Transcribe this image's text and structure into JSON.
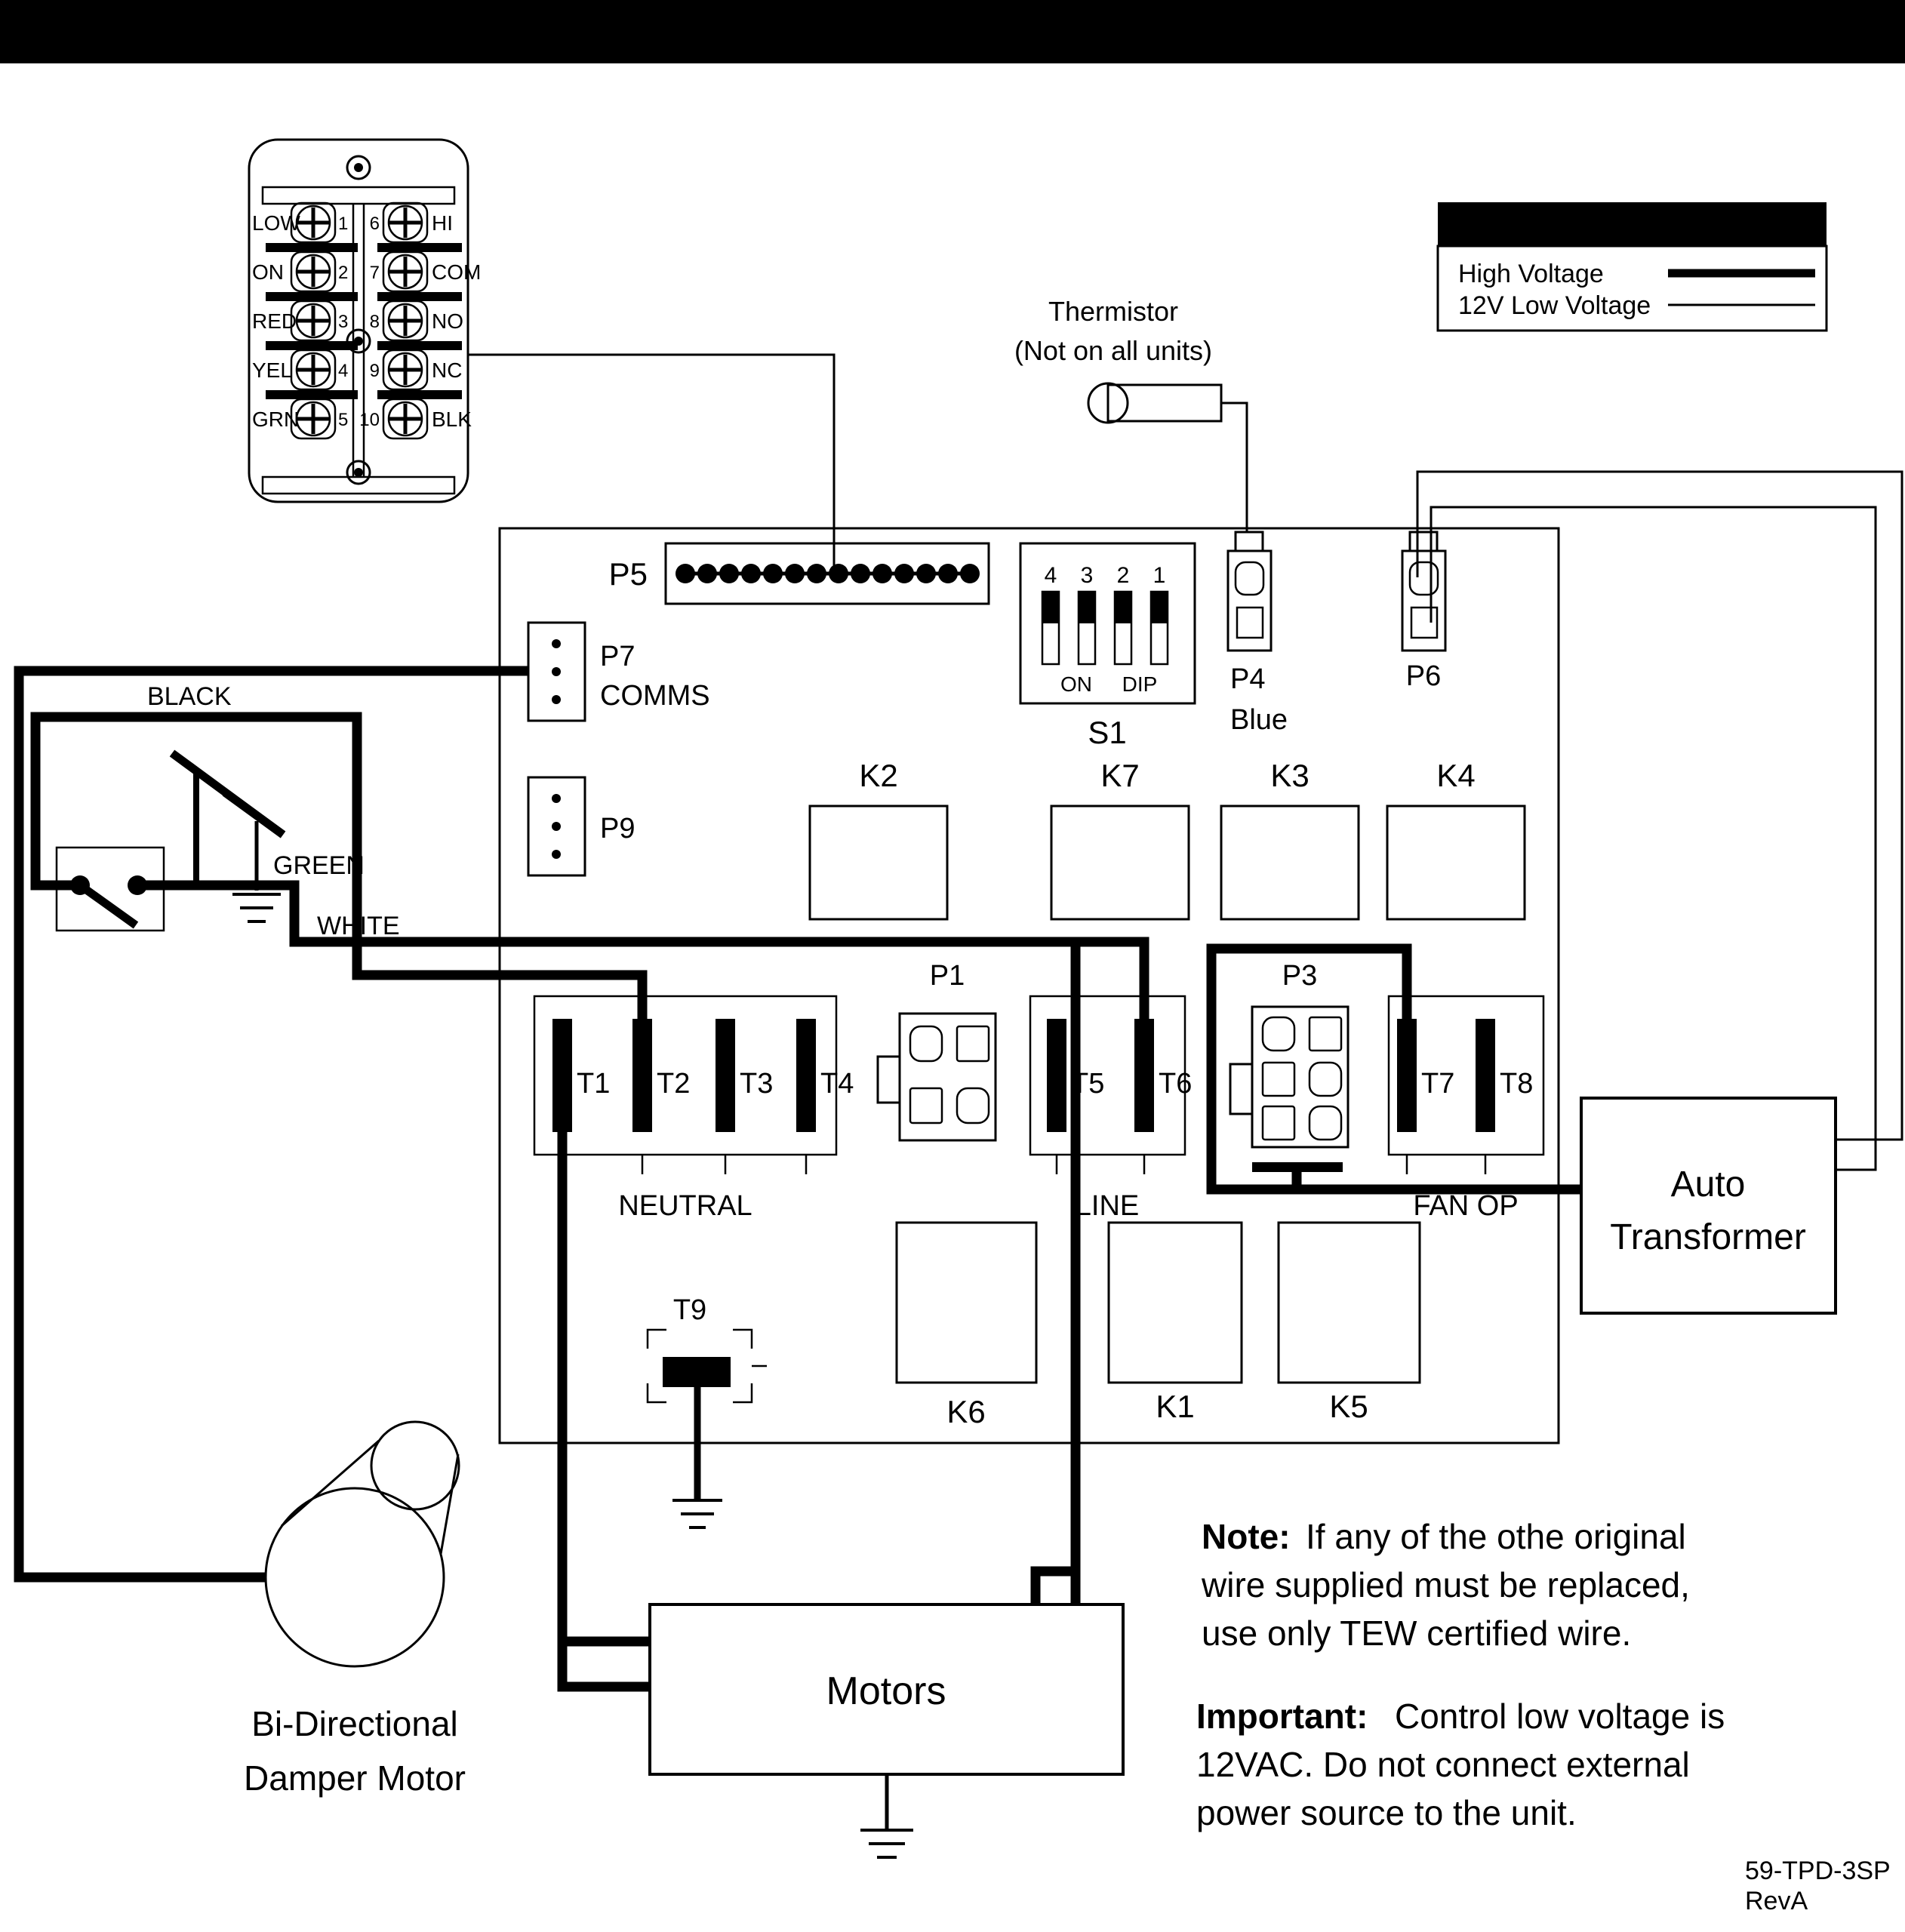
{
  "banner": {
    "bold": "CAUTION:",
    "rest": "ELECTRICAL CONTROL PANEL, SERVICE  BY ELECTRICIAN ONLY"
  },
  "terminal_rows": [
    {
      "left": "LOW",
      "lnum": "1",
      "rnum": "6",
      "right": "HI"
    },
    {
      "left": "ON",
      "lnum": "2",
      "rnum": "7",
      "right": "COM"
    },
    {
      "left": "RED",
      "lnum": "3",
      "rnum": "8",
      "right": "NO"
    },
    {
      "left": "YEL",
      "lnum": "4",
      "rnum": "9",
      "right": "NC"
    },
    {
      "left": "GRN",
      "lnum": "5",
      "rnum": "10",
      "right": "BLK"
    }
  ],
  "legend": {
    "title": "Legend",
    "high_voltage": "High Voltage",
    "low_voltage": "12V Low Voltage"
  },
  "thermistor": {
    "line1": "Thermistor",
    "line2": "(Not on all units)"
  },
  "connectors": {
    "p5": "P5",
    "p7": "P7",
    "p7_sub": "COMMS",
    "p9": "P9",
    "p4": "P4",
    "p4_sub": "Blue",
    "p6": "P6",
    "p1": "P1",
    "p3": "P3"
  },
  "dip_switch": {
    "n4": "4",
    "n3": "3",
    "n2": "2",
    "n1": "1",
    "on": "ON",
    "dip": "DIP",
    "name": "S1"
  },
  "relays": {
    "k2": "K2",
    "k7": "K7",
    "k3": "K3",
    "k4": "K4",
    "k6": "K6",
    "k1": "K1",
    "k5": "K5"
  },
  "terminals": {
    "t1": "T1",
    "t2": "T2",
    "t3": "T3",
    "t4": "T4",
    "t5": "T5",
    "t6": "T6",
    "t7": "T7",
    "t8": "T8",
    "t9": "T9",
    "neutral": "NEUTRAL",
    "line": "LINE",
    "fan_op": "FAN OP"
  },
  "wires": {
    "black": "BLACK",
    "green": "GREEN",
    "white": "WHITE"
  },
  "blocks": {
    "motors": "Motors",
    "auto_line1": "Auto",
    "auto_line2": "Transformer",
    "damper_line1": "Bi-Directional",
    "damper_line2": "Damper Motor"
  },
  "notes": {
    "note_bold": "Note:",
    "note_l1": "If any of the othe original",
    "note_l2": "wire supplied must be replaced,",
    "note_l3": "use only TEW certified wire.",
    "imp_bold": "Important:",
    "imp_l1": "Control low voltage is",
    "imp_l2": "12VAC. Do not connect external",
    "imp_l3": "power source to the unit."
  },
  "doc": {
    "code": "59-TPD-3SP",
    "rev": "RevA"
  }
}
